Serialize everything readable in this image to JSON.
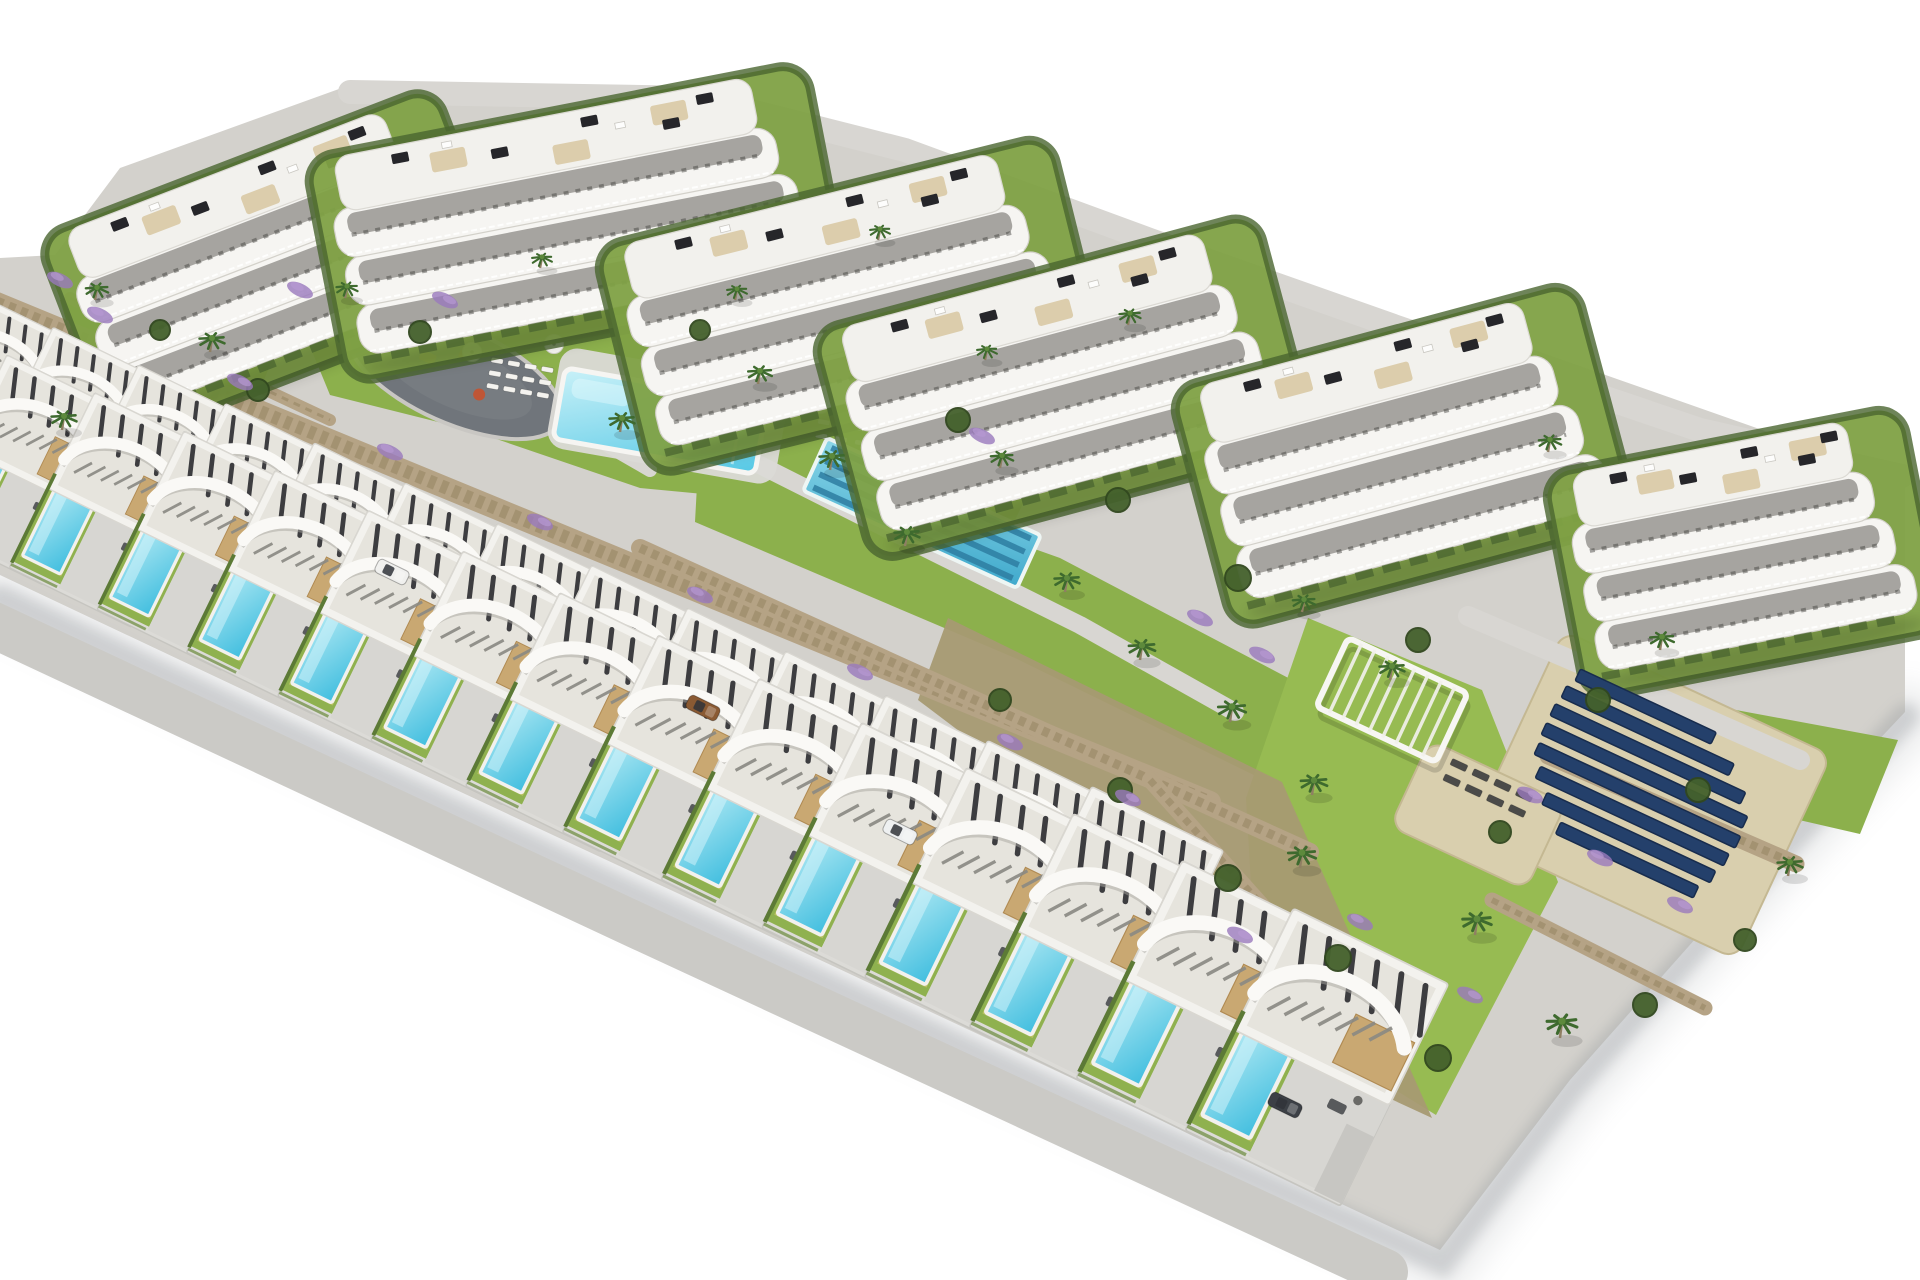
{
  "scene": {
    "description": "Aerial 3D architectural rendering of a hillside residential development: six white apartment blocks with curved balconies along the top, two staggered diagonal rows of modern white villas with private pools below, communal lawns with a main pool and a lap pool, a playground, stone retaining walls, lavender planting, palm trees and a solar panel field on the right",
    "canvas": {
      "width": 1920,
      "height": 1280,
      "background": "#ffffff"
    },
    "palette": {
      "base": "#d3d1cc",
      "shadow": "#8e9397",
      "lawn": "#8cb04c",
      "lawnBright": "#97bb52",
      "lawnDark": "#7da23f",
      "hedge": "#4a6530",
      "bush": "#44612c",
      "stone": "#b5a385",
      "stoneDark": "#93825f",
      "slope": "#a79a72",
      "path": "#d8d6d2",
      "road": "#c2c1bd",
      "roadLight": "#cbcac6",
      "playground": "#70757b",
      "poolMain": "#55c8e5",
      "poolLight": "#aee8f3",
      "poolVilla": "#41bedf",
      "poolLane": "#2e7ea2",
      "lapPool": "#3fa9cc",
      "slab": "#f6f5f2",
      "slabEdge": "#d3d1ca",
      "glass": "#55534d",
      "roofGravel": "#e6e4dd",
      "slat": "#2f2f33",
      "wood": "#c9a872",
      "terrace": "#d9c9a4",
      "panel": "#26262a",
      "solar": "#24406b",
      "solarEdge": "#182c4d",
      "sand": "#d9cfae",
      "palm": "#3e6a2e",
      "palmTrunk": "#8f7f63",
      "lavender": "#9a79bd"
    },
    "site_outline": "55,255 120,168 350,85 700,88 860,140 1100,225 1290,295 1520,345 1905,480 1905,712 1760,866 1570,1080 1440,1250 1080,1082 720,913 360,745 0,575 0,258",
    "shadow_edge": "0,598 360,768 720,935 1080,1103 1442,1262 1572,1088 1762,872 1906,716",
    "lawns": [
      {
        "name": "pool-lawn",
        "color": "lawn",
        "points": "300,322 480,288 700,298 800,332 1060,428 1015,520 820,505 640,488 470,430 330,395"
      },
      {
        "name": "lap-pool-lawn",
        "color": "lawn",
        "points": "700,430 1060,558 1315,692 1268,782 1015,658 695,522"
      },
      {
        "name": "pergola-lawn",
        "color": "lawnBright",
        "points": "1308,618 1482,690 1558,882 1436,1115 1258,1005 1246,798"
      },
      {
        "name": "block6-lawn",
        "color": "lawn",
        "points": "1552,676 1898,740 1860,834 1548,762"
      },
      {
        "name": "block1-west-lawn",
        "color": "lawn",
        "points": "60,300 200,250 300,290 260,390 90,400"
      }
    ],
    "slope": {
      "points": "948,618 1282,782 1432,1118 1302,1058 1180,898 918,700"
    },
    "paths": [
      {
        "name": "ridge-road",
        "points": "350,92 700,98 905,150 1150,240 1405,330 1700,430 1902,476",
        "w": 24,
        "color": "path"
      },
      {
        "name": "garden-path",
        "points": "540,415 760,465 905,538 1080,625 1235,712",
        "w": 18,
        "color": "path"
      },
      {
        "name": "pool-path",
        "points": "420,350 520,395 650,470",
        "w": 14,
        "color": "path"
      },
      {
        "name": "back-row-road",
        "points": "-70,488 600,812 1185,1096",
        "w": 26,
        "color": "road"
      },
      {
        "name": "front-road",
        "points": "-60,600 640,927 1385,1272",
        "w": 46,
        "color": "roadLight"
      },
      {
        "name": "right-access-road",
        "points": "1468,616 1660,698 1800,760",
        "w": 20,
        "color": "path"
      }
    ],
    "walls": [
      {
        "name": "retaining-wall-villas",
        "x1": -40,
        "y1": 288,
        "x2": 1210,
        "y2": 802,
        "w": 22
      },
      {
        "name": "retaining-wall-lap",
        "x1": 640,
        "y1": 548,
        "x2": 1310,
        "y2": 852,
        "w": 18
      },
      {
        "name": "retaining-wall-right-upper",
        "x1": 1548,
        "y1": 756,
        "x2": 1796,
        "y2": 864,
        "w": 17
      },
      {
        "name": "retaining-wall-right-lower",
        "x1": 1492,
        "y1": 900,
        "x2": 1705,
        "y2": 1008,
        "w": 15
      },
      {
        "name": "retaining-wall-slope",
        "x1": 1150,
        "y1": 780,
        "x2": 1400,
        "y2": 1060,
        "w": 16
      },
      {
        "name": "perimeter-hedge-wall",
        "x1": 70,
        "y1": 298,
        "x2": 330,
        "y2": 420,
        "w": 12
      }
    ],
    "playground": {
      "cx": 455,
      "cy": 375,
      "rx": 115,
      "ry": 48,
      "angle": 24,
      "items": [
        {
          "t": "rect",
          "x": -40,
          "y": -10,
          "w": 16,
          "h": 10,
          "c": "#d9a13a"
        },
        {
          "t": "circle",
          "x": 30,
          "y": 8,
          "r": 6,
          "c": "#bf5636"
        },
        {
          "t": "rect",
          "x": -5,
          "y": -26,
          "w": 12,
          "h": 8,
          "c": "#c77c3e"
        }
      ]
    },
    "pool_deck": {
      "cx": 668,
      "cy": 416,
      "w": 232,
      "h": 102,
      "angle": 10
    },
    "main_pool": {
      "cx": 660,
      "cy": 421,
      "len": 205,
      "wid": 72,
      "angle": 10
    },
    "lap_pool": {
      "cx": 922,
      "cy": 513,
      "len": 235,
      "wid": 58,
      "angle": 24.5,
      "lanes": 4
    },
    "lounger_clusters": [
      {
        "name": "pool-loungers-west",
        "cx": 520,
        "cy": 378,
        "cols": 4,
        "rows": 3,
        "dx": 17,
        "dy": 13,
        "angle": 10,
        "color": "#f4f3ef",
        "w": 12,
        "h": 5
      },
      {
        "name": "pool-loungers-east",
        "cx": 862,
        "cy": 436,
        "cols": 5,
        "rows": 2,
        "dx": 20,
        "dy": 14,
        "angle": 10,
        "color": "#f4f3ef",
        "w": 12,
        "h": 5
      },
      {
        "name": "solarium-loungers",
        "cx": 1488,
        "cy": 788,
        "cols": 4,
        "rows": 2,
        "dx": 24,
        "dy": 17,
        "angle": 25,
        "color": "#4b4b49",
        "w": 17,
        "h": 7
      }
    ],
    "umbrellas": [
      [
        472,
        352
      ],
      [
        554,
        344
      ],
      [
        738,
        390
      ],
      [
        820,
        404
      ],
      [
        898,
        434
      ],
      [
        952,
        460
      ]
    ],
    "buildings": [
      {
        "name": "apartment-block-1",
        "cx": 272,
        "cy": 258,
        "w": 385,
        "h": 178,
        "angle": -21
      },
      {
        "name": "apartment-block-2",
        "cx": 575,
        "cy": 215,
        "w": 470,
        "h": 185,
        "angle": -11
      },
      {
        "name": "apartment-block-3",
        "cx": 848,
        "cy": 298,
        "w": 430,
        "h": 192,
        "angle": -14
      },
      {
        "name": "apartment-block-4",
        "cx": 1062,
        "cy": 380,
        "w": 420,
        "h": 195,
        "angle": -15
      },
      {
        "name": "apartment-block-5",
        "cx": 1402,
        "cy": 448,
        "w": 380,
        "h": 205,
        "angle": -15
      },
      {
        "name": "apartment-block-6",
        "cx": 1742,
        "cy": 545,
        "w": 325,
        "h": 185,
        "angle": -11
      }
    ],
    "villas": {
      "rows": [
        {
          "name": "villa-back-row",
          "count": 13,
          "sx": -15,
          "sy": 390,
          "dx": 84,
          "dy": 39,
          "scale0": 0.78,
          "growth": 1.02,
          "angle": 26
        },
        {
          "name": "villa-front-row",
          "count": 14,
          "sx": 25,
          "sy": 470,
          "dx": 88,
          "dy": 40,
          "scale0": 0.9,
          "growth": 1.02,
          "angle": 26
        }
      ]
    },
    "sand_pads": [
      {
        "name": "solar-field-ground",
        "cx": 1650,
        "cy": 795,
        "w": 295,
        "h": 225,
        "angle": 25
      },
      {
        "name": "sunbathing-deck",
        "cx": 1478,
        "cy": 815,
        "w": 150,
        "h": 95,
        "angle": 25
      }
    ],
    "solar_array": {
      "cx": 1640,
      "cy": 785,
      "angle": 25,
      "gap": 21,
      "w": 13,
      "lens": [
        150,
        185,
        210,
        222,
        222,
        208,
        186,
        152
      ],
      "stagger": [
        -28,
        -16,
        -6,
        0,
        2,
        6,
        12,
        20
      ]
    },
    "pergola": {
      "cx": 1392,
      "cy": 700,
      "w": 132,
      "h": 76,
      "angle": 25,
      "slats": 9
    },
    "cars": [
      {
        "x": 392,
        "y": 572,
        "c": "#f0f0ee"
      },
      {
        "x": 703,
        "y": 708,
        "c": "#8a5a33"
      },
      {
        "x": 900,
        "y": 832,
        "c": "#eef0f1"
      },
      {
        "x": 1285,
        "y": 1105,
        "c": "#3c4046"
      }
    ],
    "palms": [
      [
        95,
        300,
        0.9
      ],
      [
        210,
        352,
        1
      ],
      [
        345,
        298,
        0.85
      ],
      [
        540,
        268,
        0.8
      ],
      [
        620,
        432,
        1
      ],
      [
        758,
        384,
        0.95
      ],
      [
        830,
        470,
        1
      ],
      [
        905,
        546,
        1
      ],
      [
        1000,
        468,
        0.9
      ],
      [
        1065,
        592,
        1
      ],
      [
        1140,
        660,
        1.05
      ],
      [
        1230,
        722,
        1.1
      ],
      [
        1312,
        795,
        1.05
      ],
      [
        1390,
        680,
        1
      ],
      [
        1302,
        612,
        0.9
      ],
      [
        1475,
        935,
        1.15
      ],
      [
        1560,
        1038,
        1.2
      ],
      [
        1300,
        868,
        1.1
      ],
      [
        1660,
        650,
        0.95
      ],
      [
        1788,
        876,
        1
      ],
      [
        878,
        240,
        0.8
      ],
      [
        1128,
        325,
        0.85
      ],
      [
        1548,
        452,
        0.9
      ],
      [
        62,
        430,
        1
      ],
      [
        735,
        300,
        0.8
      ],
      [
        985,
        360,
        0.8
      ]
    ],
    "bushes": [
      [
        420,
        332,
        11
      ],
      [
        700,
        330,
        10
      ],
      [
        958,
        420,
        12
      ],
      [
        1118,
        500,
        12
      ],
      [
        1238,
        578,
        13
      ],
      [
        1418,
        640,
        12
      ],
      [
        1598,
        700,
        12
      ],
      [
        1000,
        700,
        11
      ],
      [
        1120,
        790,
        12
      ],
      [
        1228,
        878,
        13
      ],
      [
        1338,
        958,
        13
      ],
      [
        1438,
        1058,
        13
      ],
      [
        160,
        330,
        10
      ],
      [
        258,
        390,
        11
      ],
      [
        1698,
        790,
        12
      ],
      [
        1500,
        832,
        11
      ],
      [
        1645,
        1005,
        12
      ],
      [
        1745,
        940,
        11
      ]
    ],
    "lavender": [
      [
        100,
        315
      ],
      [
        240,
        382
      ],
      [
        390,
        452
      ],
      [
        540,
        522
      ],
      [
        700,
        595
      ],
      [
        860,
        672
      ],
      [
        1010,
        742
      ],
      [
        1128,
        798
      ],
      [
        60,
        280
      ],
      [
        1530,
        795
      ],
      [
        1600,
        858
      ],
      [
        1470,
        995
      ],
      [
        1360,
        922
      ],
      [
        1240,
        935
      ],
      [
        982,
        436
      ],
      [
        445,
        300
      ],
      [
        300,
        290
      ],
      [
        1680,
        905
      ],
      [
        1200,
        618
      ],
      [
        1262,
        655
      ]
    ]
  }
}
